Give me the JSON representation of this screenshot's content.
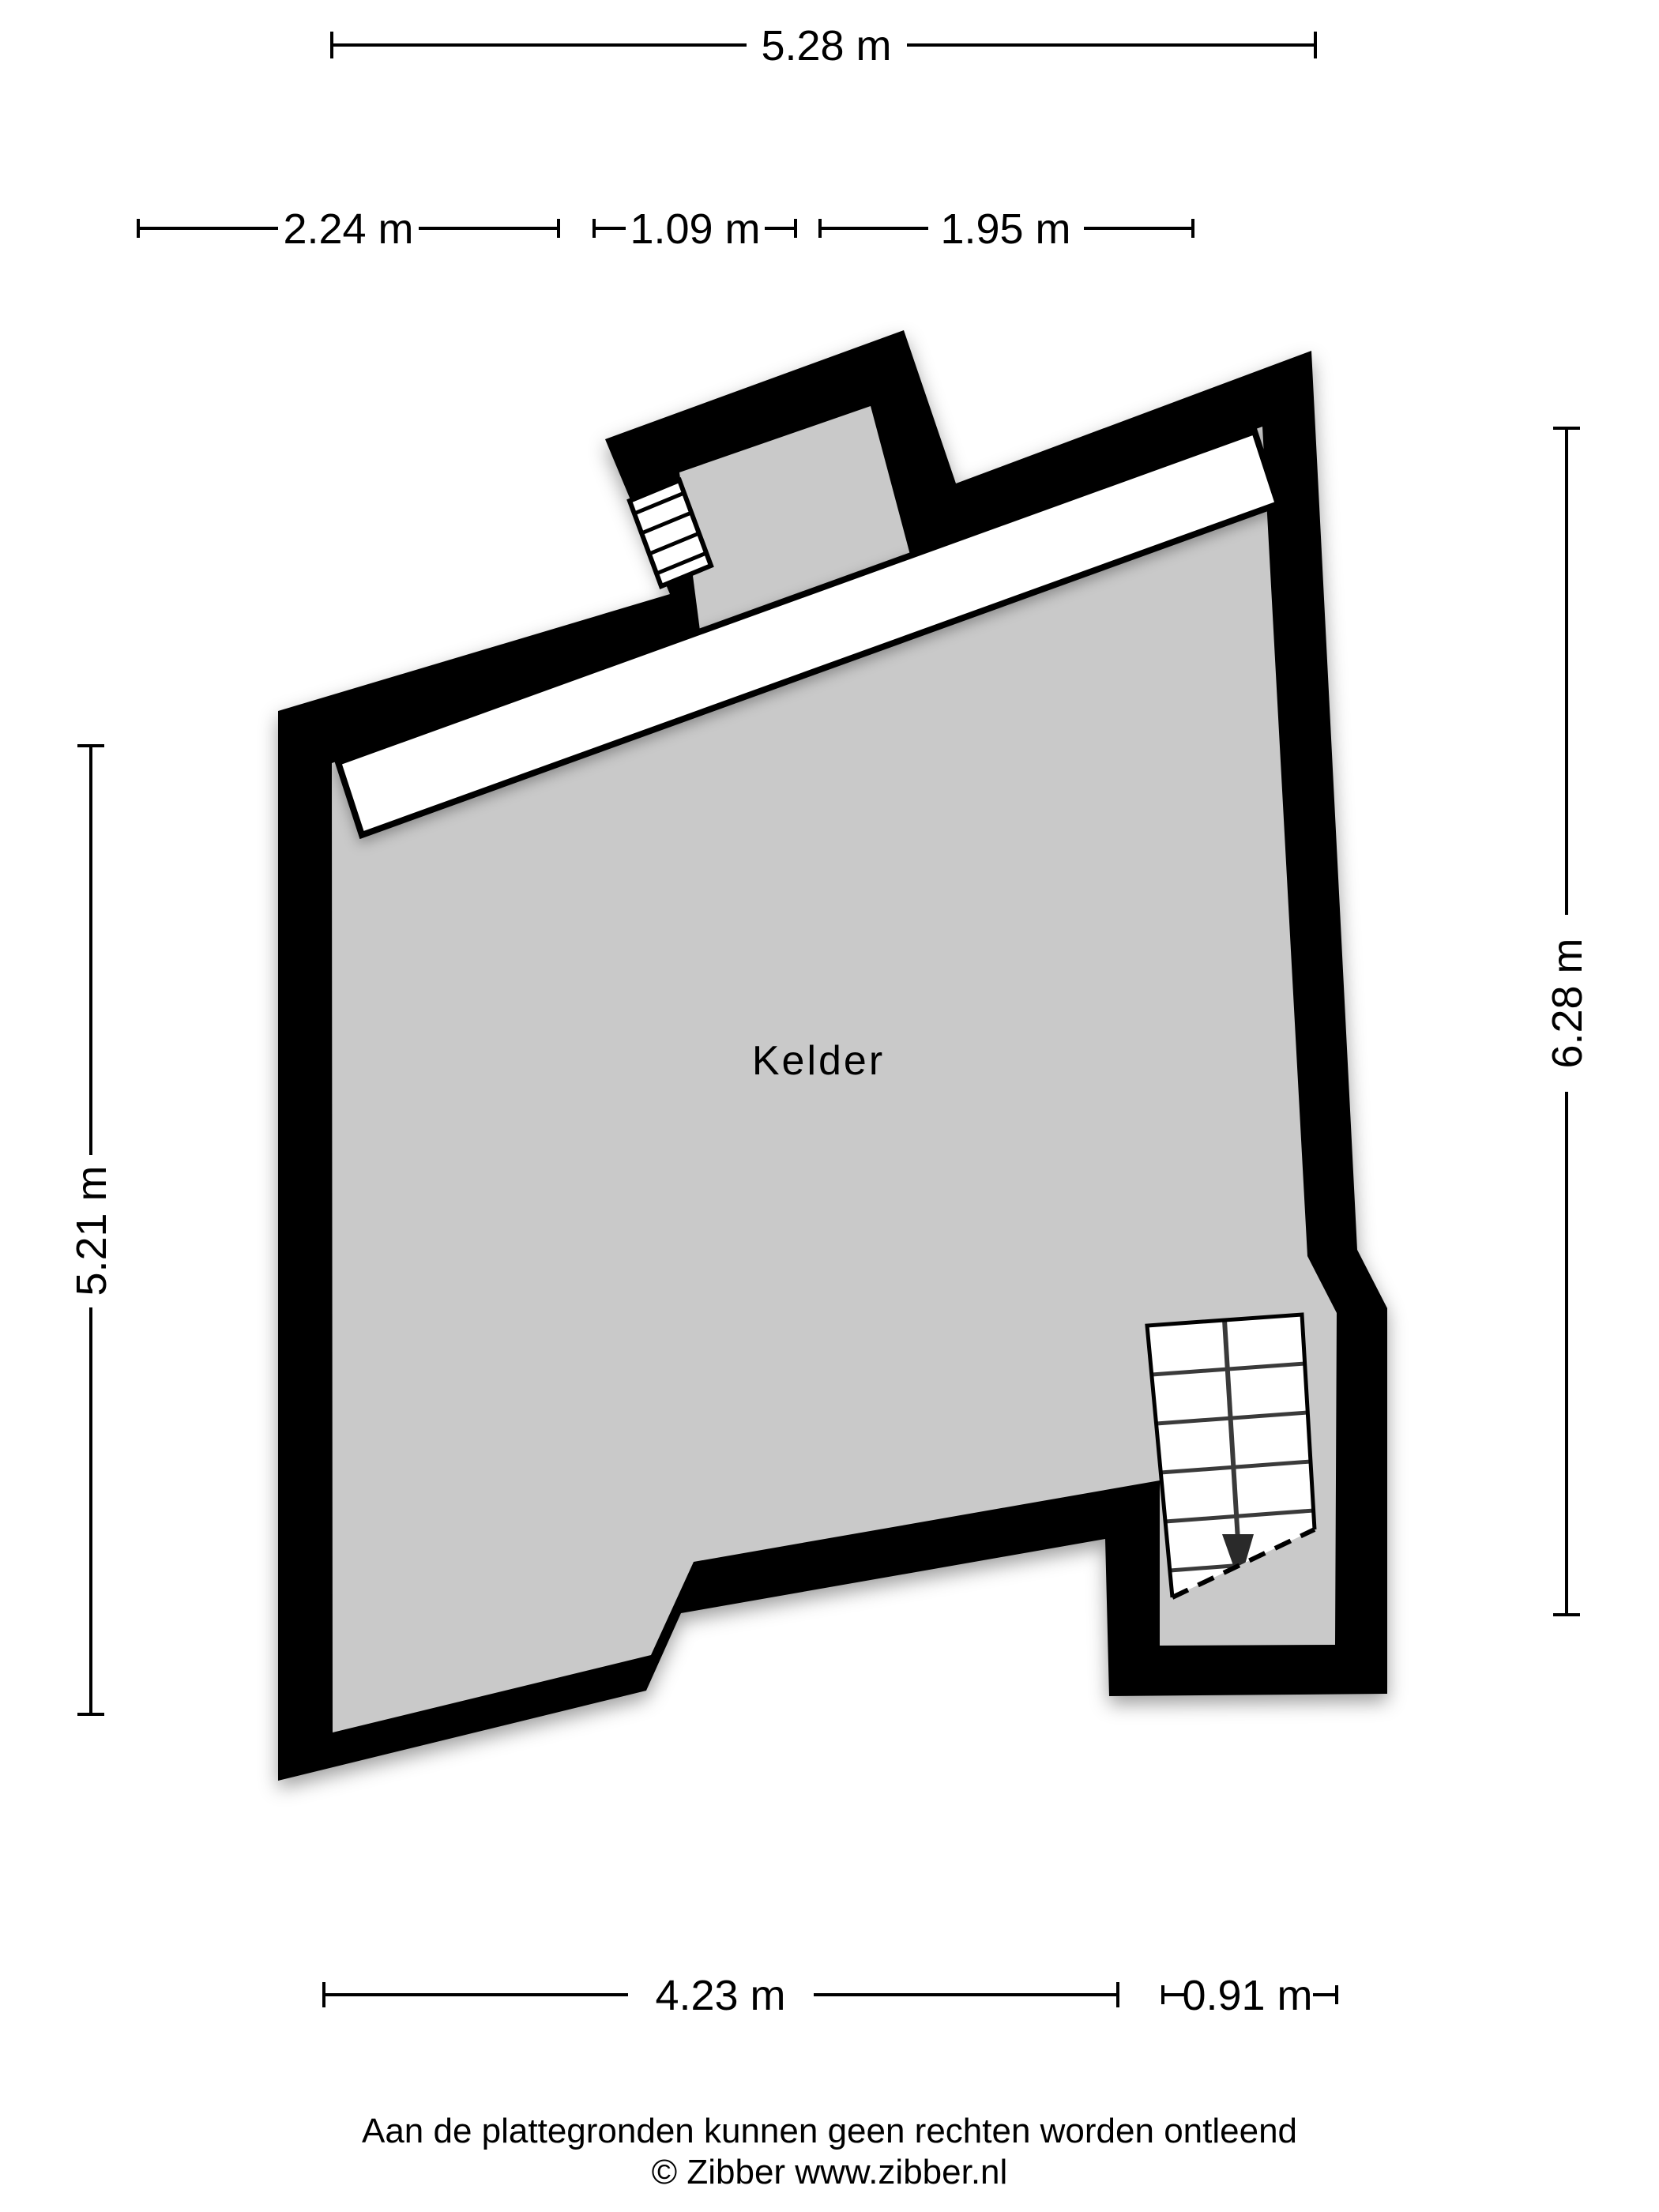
{
  "room": {
    "label": "Kelder"
  },
  "dims": {
    "top": "5.28 m",
    "row2": [
      "2.24 m",
      "1.09 m",
      "1.95 m"
    ],
    "left": "5.21 m",
    "right": "6.28 m",
    "bottom": [
      "4.23 m",
      "0.91 m"
    ]
  },
  "footer": {
    "disclaimer": "Aan de plattegronden kunnen geen rechten worden ontleend",
    "copyright": "© Zibber www.zibber.nl"
  },
  "colors": {
    "wall": "#000000",
    "floor": "#c9c9c9",
    "stairs": "#ffffff",
    "background": "#ffffff"
  }
}
